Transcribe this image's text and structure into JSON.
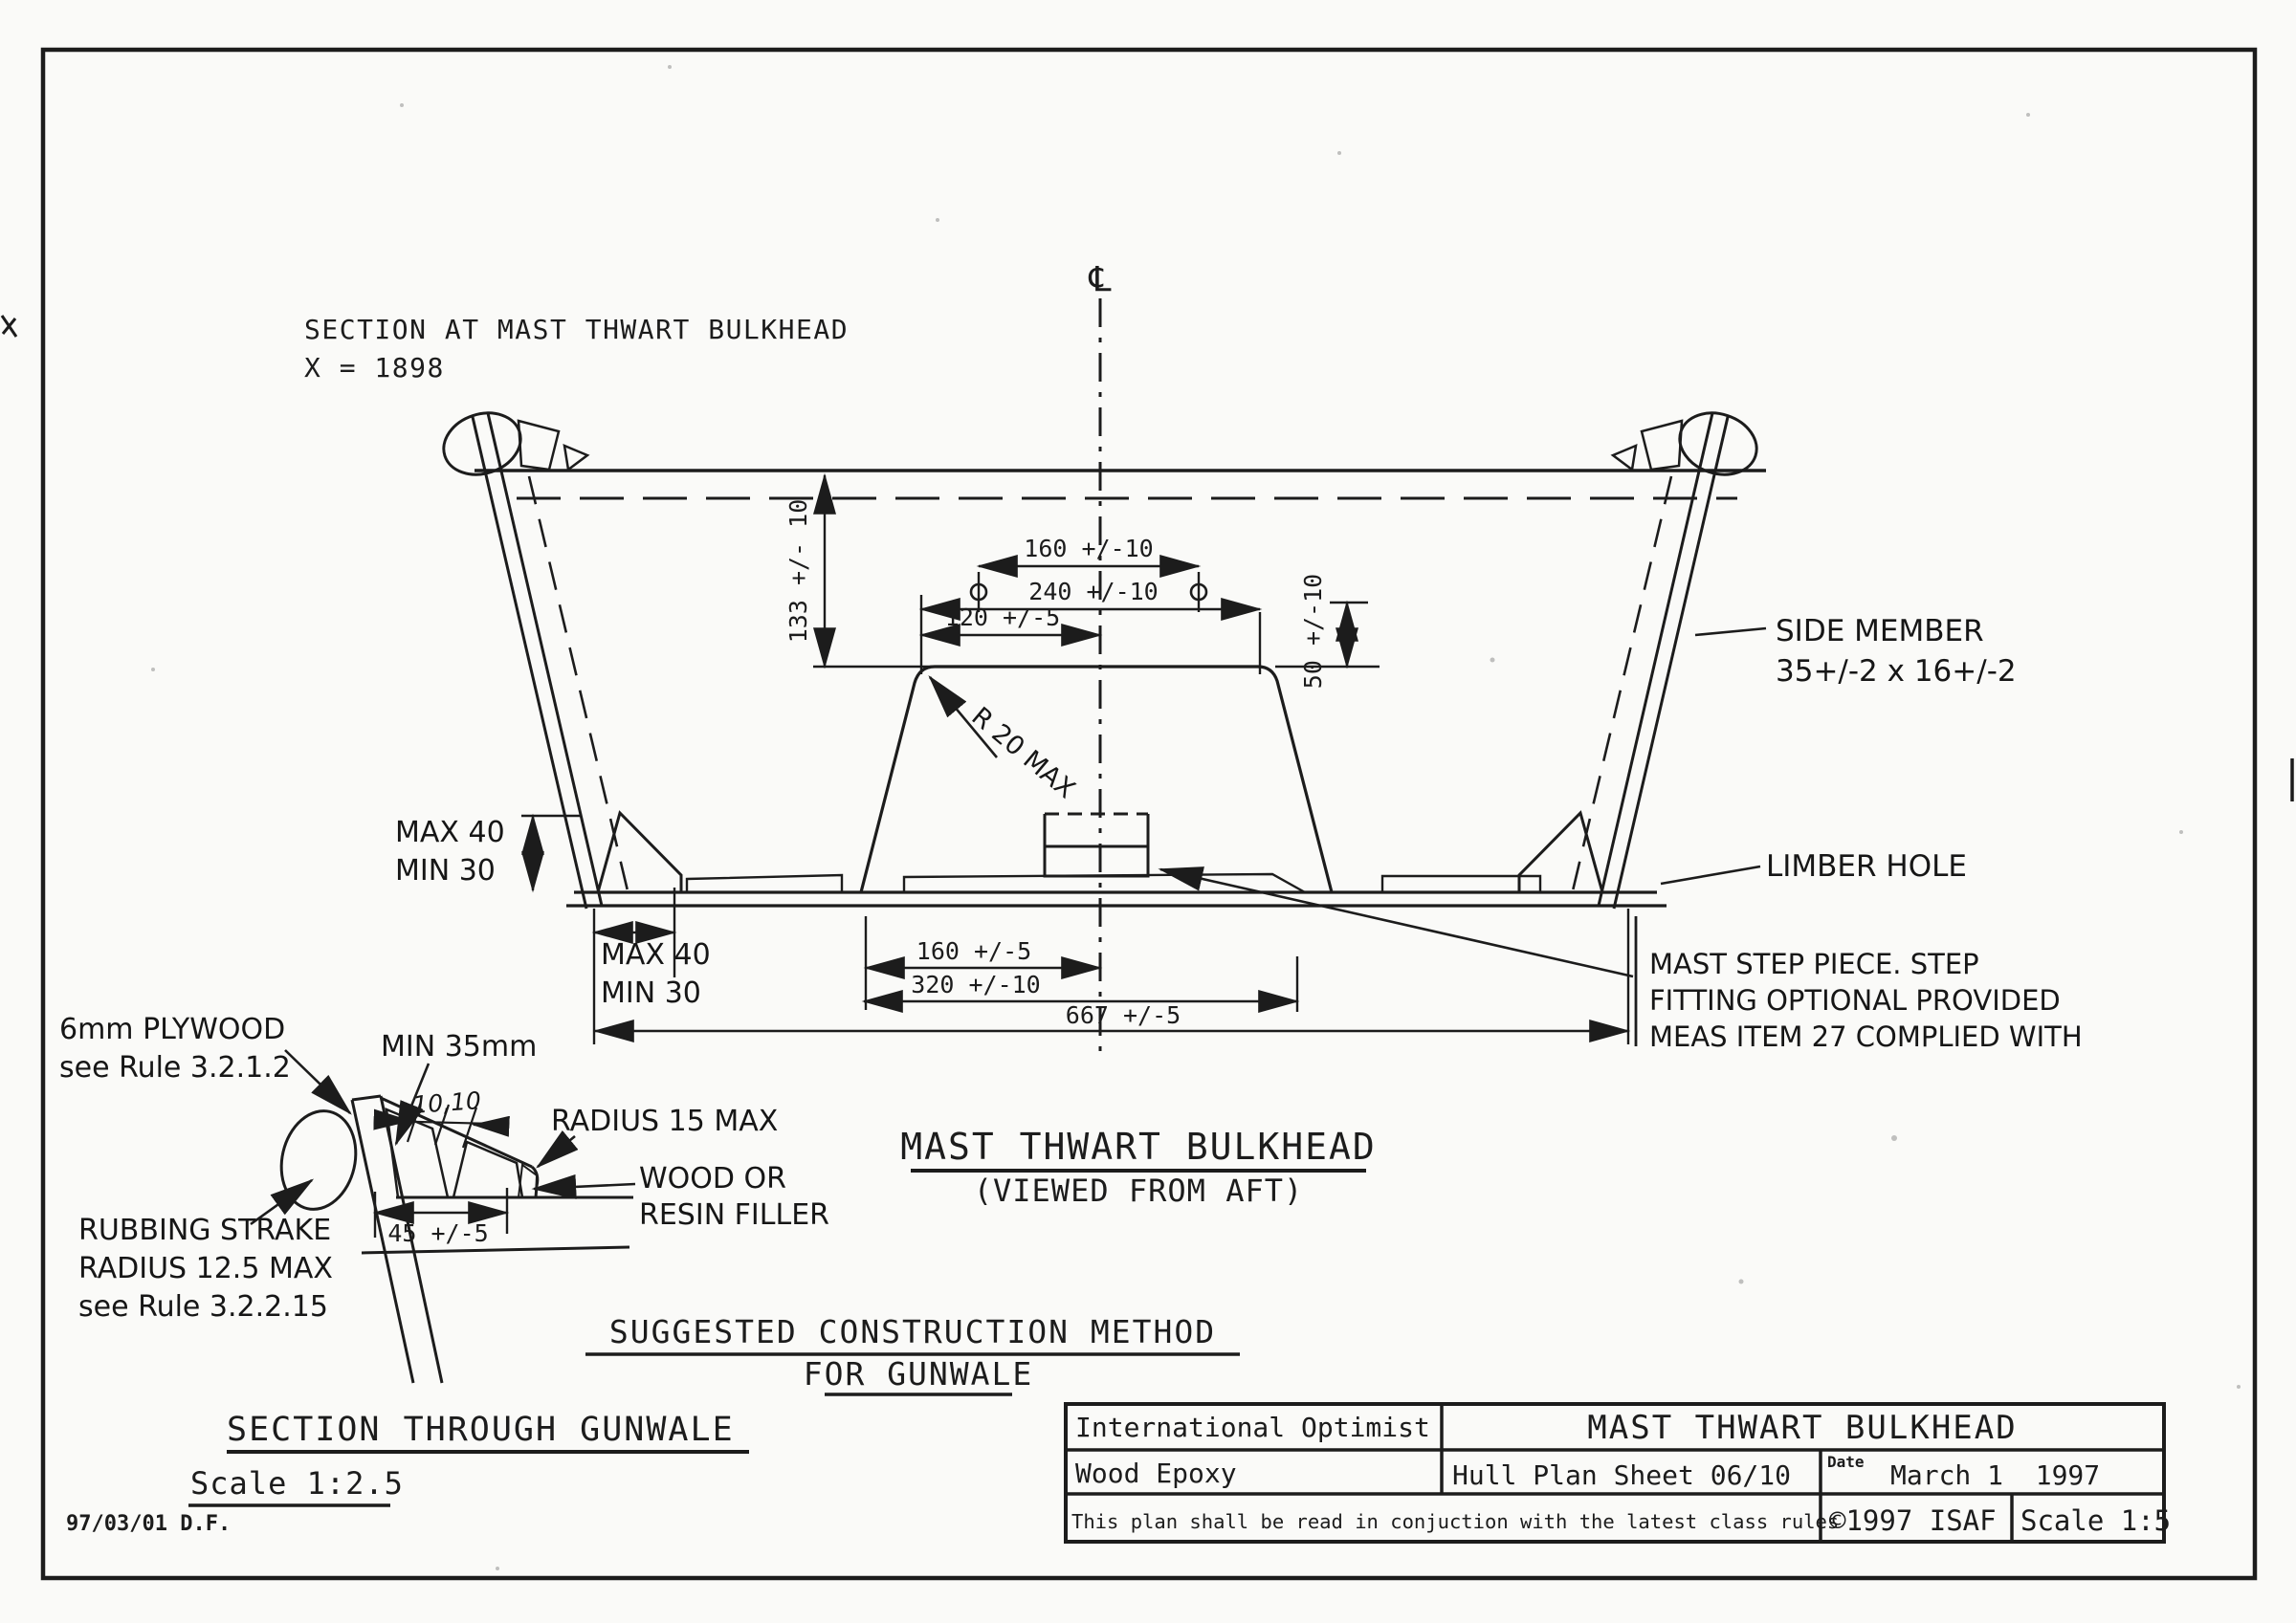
{
  "ink_color": "#1c1c1c",
  "paper_color": "#fafaf8",
  "section_header": {
    "line1": "SECTION AT MAST THWART BULKHEAD",
    "line2": "X = 1898",
    "centerline_symbol": "℄"
  },
  "dimensions": {
    "top_160": "160 +/-10",
    "top_240": "240 +/-10",
    "top_120": "120 +/-5",
    "height_133": "133 +/- 10",
    "height_50": "50 +/-10",
    "radius_step": "R 20 MAX",
    "knee_max": "MAX 40",
    "knee_min": "MIN 30",
    "bottom_160": "160 +/-5",
    "bottom_320": "320 +/-10",
    "bottom_667": "667 +/-5",
    "gunwale_45": "45 +/-5",
    "gunwale_10_10": "10,10",
    "gunwale_min35": "MIN 35mm"
  },
  "labels": {
    "side_member_1": "SIDE MEMBER",
    "side_member_2": "35+/-2 x 16+/-2",
    "limber_hole": "LIMBER HOLE",
    "mast_step_1": "MAST STEP PIECE. STEP",
    "mast_step_2": "FITTING OPTIONAL PROVIDED",
    "mast_step_3": "MEAS ITEM 27 COMPLIED WITH",
    "plywood_1": "6mm PLYWOOD",
    "plywood_2": "see Rule 3.2.1.2",
    "radius_15": "RADIUS 15 MAX",
    "filler_1": "WOOD OR",
    "filler_2": "RESIN FILLER",
    "rubbing_1": "RUBBING STRAKE",
    "rubbing_2": "RADIUS 12.5 MAX",
    "rubbing_3": "see Rule 3.2.2.15"
  },
  "headings": {
    "view_title": "MAST THWART BULKHEAD",
    "view_subtitle": "(VIEWED FROM AFT)",
    "construction_1": "SUGGESTED CONSTRUCTION METHOD",
    "construction_2": "FOR GUNWALE",
    "gunwale_section": "SECTION THROUGH GUNWALE",
    "gunwale_scale": "Scale 1:2.5",
    "revision": "97/03/01 D.F."
  },
  "title_block": {
    "class_name": "International Optimist",
    "sheet_title": "MAST THWART BULKHEAD",
    "material": "Wood Epoxy",
    "sheet_number": "Hull Plan Sheet 06/10",
    "date_label": "Date",
    "date_value": "March 1  1997",
    "note": "This plan shall be read in conjuction with the latest class rules",
    "copyright": "©1997 ISAF",
    "scale": "Scale 1:5"
  }
}
